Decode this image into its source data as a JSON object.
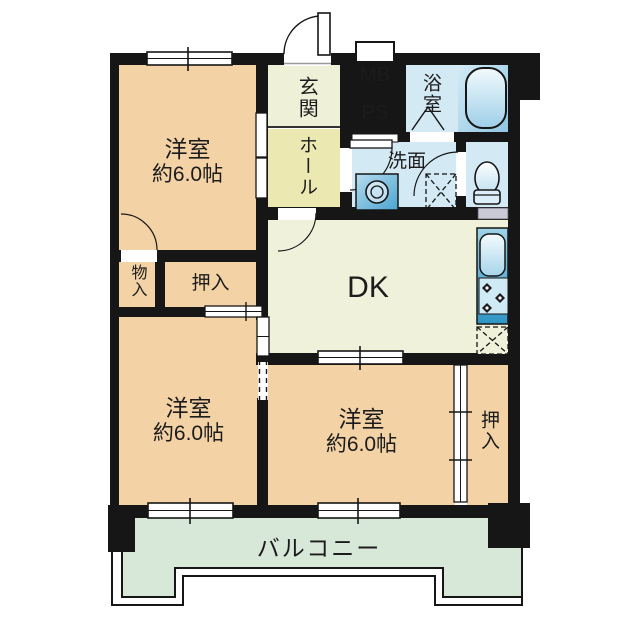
{
  "plan_type": "floor-plan",
  "rooms": {
    "bedroom1": {
      "label": "洋室",
      "size": "約6.0帖"
    },
    "bedroom2": {
      "label": "洋室",
      "size": "約6.0帖"
    },
    "bedroom3": {
      "label": "洋室",
      "size": "約6.0帖"
    },
    "entrance": {
      "label": "玄関"
    },
    "hall": {
      "label": "ホール"
    },
    "meter_box": {
      "label": "MB"
    },
    "pipe_space": {
      "label": "PS"
    },
    "bathroom": {
      "label": "浴室"
    },
    "washroom": {
      "label": "洗面"
    },
    "storage": {
      "label": "物入"
    },
    "closet_middle": {
      "label": "押入"
    },
    "closet_right": {
      "label": "押入"
    },
    "dining_kitchen": {
      "label": "DK"
    },
    "balcony": {
      "label": "バルコニー"
    }
  },
  "icons": {
    "bathtub": "rounded-rect-tub",
    "toilet": "bowl-and-tank",
    "washbasin": "double-circle-basin",
    "washing-machine-space": "dashed-box-x",
    "kitchen-sink": "rounded-rect-sink",
    "stove": "three-burners",
    "refrigerator-space": "dashed-box-x",
    "door-swing": "quarter-arc",
    "sliding-door": "double-line",
    "window": "double-line-tick",
    "folding-door": "chevron"
  },
  "colors": {
    "wall": "#161616",
    "bedroom": "#f3d2a6",
    "entrance": "#eef0d8",
    "hall": "#ebe8b2",
    "dk": "#f0f1da",
    "wet": "#d3e9f3",
    "utility": "#d4d5e2",
    "balcony": "#d7e7d8",
    "counter_blue": "#2f95c5",
    "shelf_gray": "#c9cad6"
  }
}
